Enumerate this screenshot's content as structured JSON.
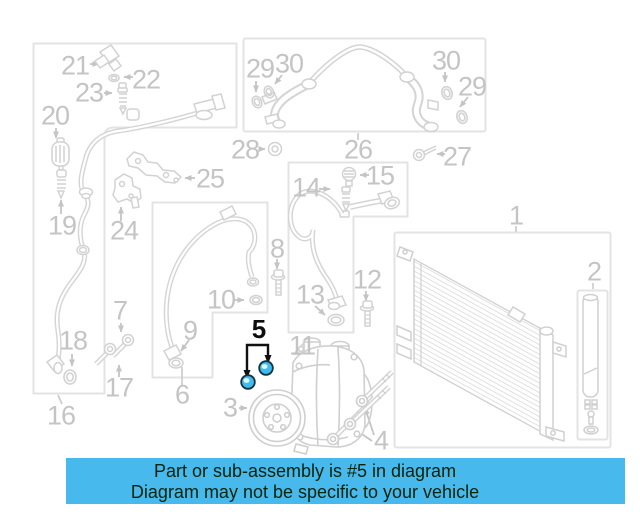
{
  "diagram": {
    "highlighted_part": "5",
    "callouts": [
      {
        "id": "1",
        "label": "1",
        "x": 516,
        "y": 216,
        "highlight": false
      },
      {
        "id": "2",
        "label": "2",
        "x": 594,
        "y": 272,
        "highlight": false
      },
      {
        "id": "3",
        "label": "3",
        "x": 230,
        "y": 408,
        "highlight": false
      },
      {
        "id": "4",
        "label": "4",
        "x": 381,
        "y": 441,
        "highlight": false
      },
      {
        "id": "5",
        "label": "5",
        "x": 259,
        "y": 329,
        "highlight": true
      },
      {
        "id": "6",
        "label": "6",
        "x": 182,
        "y": 395,
        "highlight": false
      },
      {
        "id": "7",
        "label": "7",
        "x": 120,
        "y": 311,
        "highlight": false
      },
      {
        "id": "8",
        "label": "8",
        "x": 277,
        "y": 249,
        "highlight": false
      },
      {
        "id": "9",
        "label": "9",
        "x": 190,
        "y": 331,
        "highlight": false
      },
      {
        "id": "10",
        "label": "10",
        "x": 221,
        "y": 300,
        "highlight": false
      },
      {
        "id": "11",
        "label": "11",
        "x": 302,
        "y": 346,
        "highlight": false
      },
      {
        "id": "12",
        "label": "12",
        "x": 367,
        "y": 280,
        "highlight": false
      },
      {
        "id": "13",
        "label": "13",
        "x": 310,
        "y": 295,
        "highlight": false
      },
      {
        "id": "14",
        "label": "14",
        "x": 306,
        "y": 188,
        "highlight": false
      },
      {
        "id": "15",
        "label": "15",
        "x": 380,
        "y": 176,
        "highlight": false
      },
      {
        "id": "16",
        "label": "16",
        "x": 61,
        "y": 416,
        "highlight": false
      },
      {
        "id": "17",
        "label": "17",
        "x": 119,
        "y": 388,
        "highlight": false
      },
      {
        "id": "18",
        "label": "18",
        "x": 73,
        "y": 341,
        "highlight": false
      },
      {
        "id": "19",
        "label": "19",
        "x": 62,
        "y": 226,
        "highlight": false
      },
      {
        "id": "20",
        "label": "20",
        "x": 55,
        "y": 116,
        "highlight": false
      },
      {
        "id": "21",
        "label": "21",
        "x": 75,
        "y": 66,
        "highlight": false
      },
      {
        "id": "22",
        "label": "22",
        "x": 146,
        "y": 80,
        "highlight": false
      },
      {
        "id": "23",
        "label": "23",
        "x": 89,
        "y": 93,
        "highlight": false
      },
      {
        "id": "24",
        "label": "24",
        "x": 124,
        "y": 231,
        "highlight": false
      },
      {
        "id": "25",
        "label": "25",
        "x": 210,
        "y": 179,
        "highlight": false
      },
      {
        "id": "26",
        "label": "26",
        "x": 358,
        "y": 150,
        "highlight": false
      },
      {
        "id": "27",
        "label": "27",
        "x": 457,
        "y": 157,
        "highlight": false
      },
      {
        "id": "28",
        "label": "28",
        "x": 245,
        "y": 150,
        "highlight": false
      },
      {
        "id": "29-left",
        "label": "29",
        "x": 260,
        "y": 69,
        "highlight": false
      },
      {
        "id": "30-left",
        "label": "30",
        "x": 289,
        "y": 64,
        "highlight": false
      },
      {
        "id": "30-right",
        "label": "30",
        "x": 446,
        "y": 61,
        "highlight": false
      },
      {
        "id": "29-right",
        "label": "29",
        "x": 472,
        "y": 87,
        "highlight": false
      }
    ]
  },
  "banner": {
    "line1": "Part or sub-assembly is #5 in diagram",
    "line2": "Diagram may not be specific to your vehicle",
    "background": "#48b9ec",
    "text_color": "#07230a"
  },
  "colors": {
    "highlight_fill": "#3fbdf0",
    "line_art": "#d4d4d4",
    "box_border": "#e3e3e3",
    "label_gray": "#c4c4c4"
  }
}
